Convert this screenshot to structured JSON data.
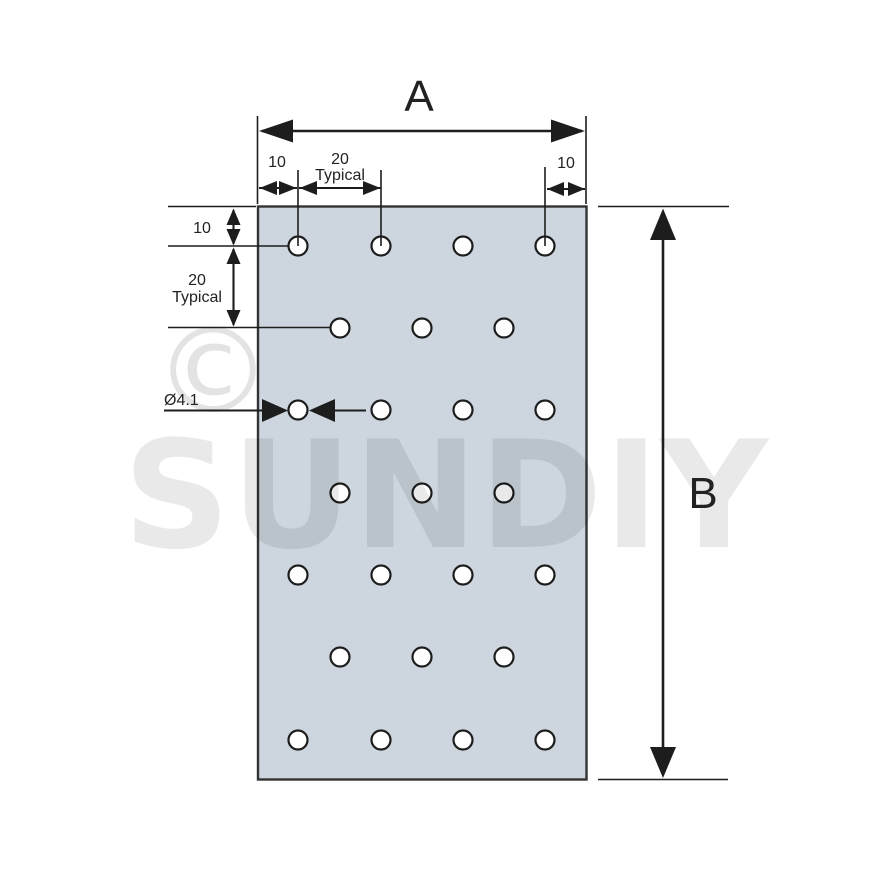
{
  "watermark": {
    "copyright": "©",
    "brand": "SUNDIY"
  },
  "labels": {
    "overall_width": "A",
    "overall_height": "B",
    "top_left_margin": "10",
    "top_pitch_value": "20",
    "top_pitch_qualifier": "Typical",
    "top_right_margin": "10",
    "side_top_margin": "10",
    "side_pitch_value": "20",
    "side_pitch_qualifier": "Typical",
    "hole_diameter": "Ø4.1"
  },
  "colors": {
    "plate_fill": "#cdd6de",
    "plate_border": "#333333",
    "hole_fill": "#ffffff",
    "line": "#1d1d1d",
    "watermark": "rgba(0,0,0,0.085)",
    "watermark_symbol": "rgba(0,0,0,0.11)"
  },
  "holes": {
    "radius": 9.5,
    "rows": [
      {
        "y": 246,
        "x": [
          298,
          381,
          463,
          545
        ]
      },
      {
        "y": 328,
        "x": [
          340,
          422,
          504
        ]
      },
      {
        "y": 410,
        "x": [
          298,
          381,
          463,
          545
        ]
      },
      {
        "y": 493,
        "x": [
          340,
          422,
          504
        ]
      },
      {
        "y": 575,
        "x": [
          298,
          381,
          463,
          545
        ]
      },
      {
        "y": 657,
        "x": [
          340,
          422,
          504
        ]
      },
      {
        "y": 740,
        "x": [
          298,
          381,
          463,
          545
        ]
      }
    ]
  }
}
